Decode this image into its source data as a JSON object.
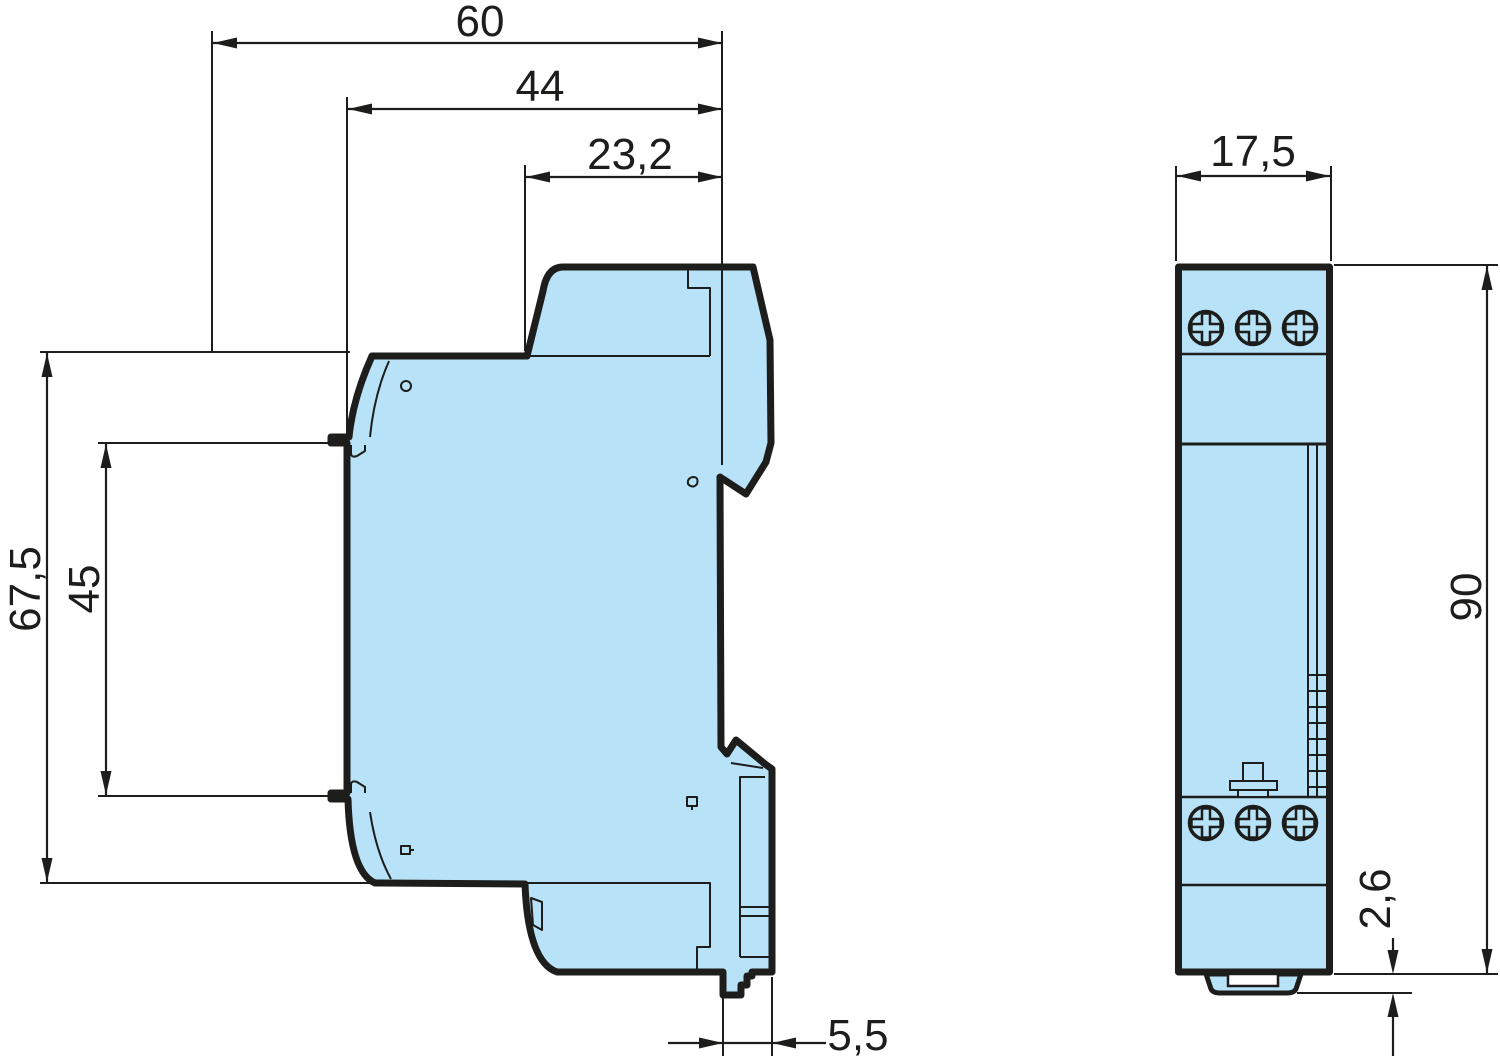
{
  "drawing": {
    "title": "dimension-drawing",
    "unit_style": "comma-decimal",
    "colors": {
      "body_fill": "#b7e2f7",
      "line": "#1d1d1b",
      "background": "#ffffff",
      "slot_fill": "#ffffff"
    },
    "side_view": {
      "name": "side view",
      "dimensions": {
        "total_depth": "60",
        "body_depth": "44",
        "upper_depth": "23,2",
        "front_height": "67,5",
        "face_height": "45",
        "rear_clip_depth": "5,5"
      }
    },
    "front_view": {
      "name": "front view",
      "dimensions": {
        "width": "17,5",
        "height": "90",
        "foot_height": "2,6"
      },
      "screws": {
        "top_count": 3,
        "bottom_count": 3
      }
    }
  }
}
